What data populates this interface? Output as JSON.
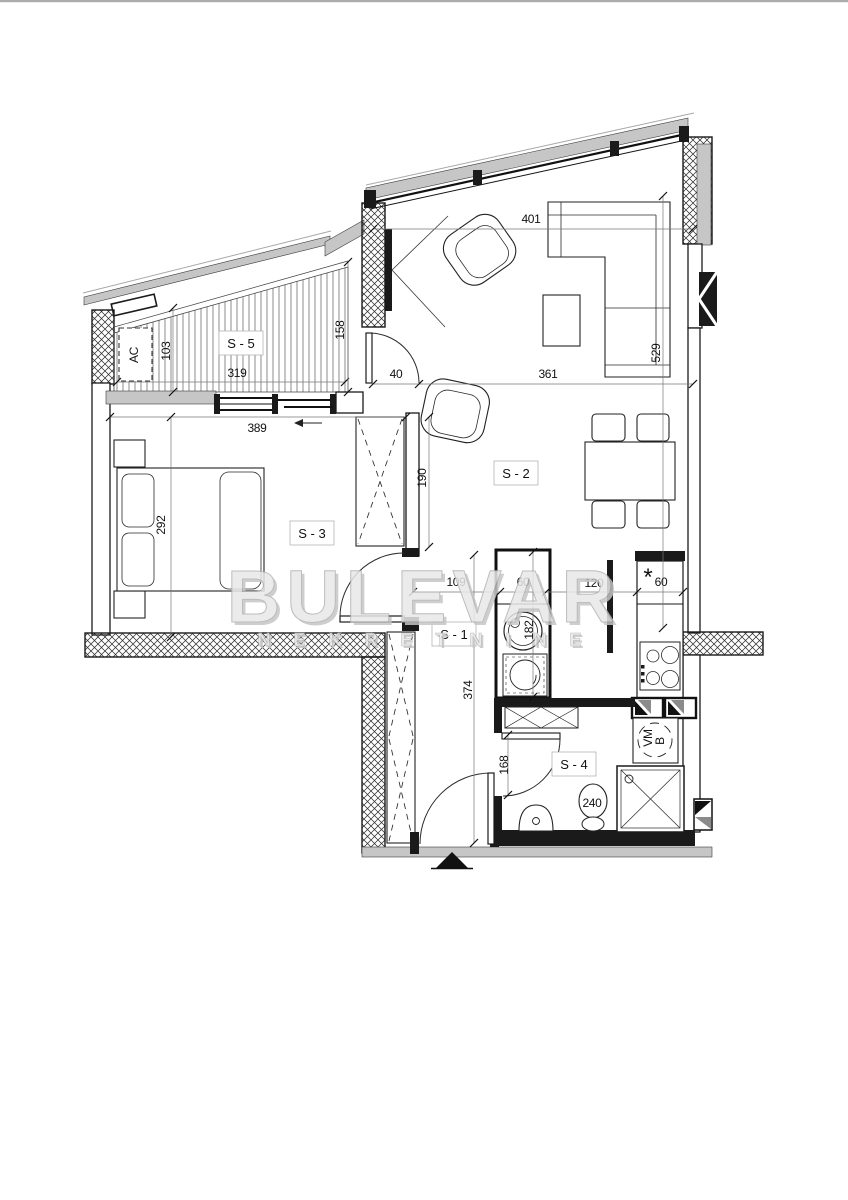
{
  "watermark": {
    "title": "BULEVAR",
    "subtitle": "N E K R E T N I N E"
  },
  "rooms": {
    "s1": "S - 1",
    "s2": "S - 2",
    "s3": "S - 3",
    "s4": "S - 4",
    "s5": "S - 5"
  },
  "fixtures": {
    "ac": "AC",
    "washer_top": "VM",
    "washer_bottom": "B",
    "sink_star": "*"
  },
  "dims": {
    "d103": "103",
    "d319": "319",
    "d158": "158",
    "d40": "40",
    "d389": "389",
    "d292": "292",
    "d190": "190",
    "d401": "401",
    "d529": "529",
    "d361": "361",
    "d109": "109",
    "d60a": "60",
    "d120": "120",
    "d60b": "60",
    "d374": "374",
    "d182": "182",
    "d168": "168",
    "d240": "240"
  },
  "colors": {
    "ink": "#1a1a1a",
    "wall_gray": "#c6c6c6",
    "dim": "#777777",
    "wm_fill": "#e8e8e8",
    "wm_stroke": "#b2b2b2",
    "wm_shadow": "#c6c6c6"
  }
}
